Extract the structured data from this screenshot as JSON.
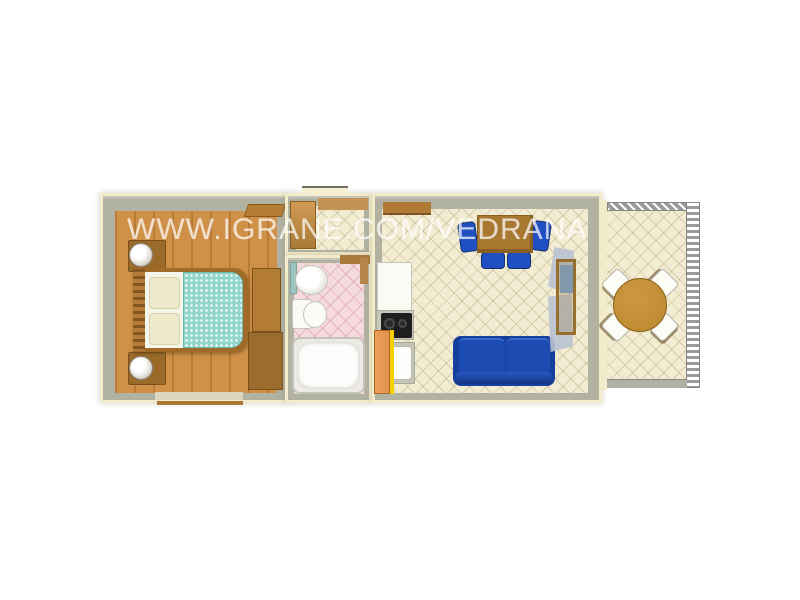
{
  "watermark": {
    "text": "WWW.IGRANE.COM/VEDRANA"
  },
  "palette": {
    "background": "#ffffff",
    "wall_outline": "#f3ecca",
    "wall_gray": "#b2b2a3",
    "wood_floor": "#cf9048",
    "tile_cream": "#f2ecd2",
    "tile_pink": "#f5dade",
    "bed_duvet": "#92d5cd",
    "bed_frame": "#a06a28",
    "pillow": "#efe9cb",
    "sofa_blue": "#1c4cb2",
    "chair_blue": "#1f4fc0",
    "table_brown": "#a87830",
    "terrace_table_brown": "#bb872f",
    "kitchen_door_orange": "#e2914c",
    "kitchen_door_yellow": "#f5d000",
    "cooktop_black": "#1e1e1e",
    "curtain_blue": "#b9c3d2",
    "railing_gray": "#9a9a9a",
    "shelf_teal": "#9cc4c0",
    "fixture_white": "#fbfbf6"
  },
  "plan": {
    "type": "apartment-floor-plan-3d-top-view",
    "rooms": [
      {
        "name": "bedroom",
        "floor": "wood",
        "furniture": [
          "double-bed",
          "nightstand-with-lamp-top",
          "nightstand-with-lamp-bottom",
          "wardrobe",
          "window-bottom-wall",
          "open-door"
        ]
      },
      {
        "name": "entrance-hall",
        "floor": "cream-tile",
        "furniture": [
          "entrance-door",
          "open-interior-door"
        ]
      },
      {
        "name": "bathroom",
        "floor": "pink-tile",
        "furniture": [
          "washbasin",
          "toilet",
          "bathtub",
          "shelf",
          "door-frame"
        ]
      },
      {
        "name": "living-room-kitchen",
        "floor": "cream-tile",
        "furniture": [
          "wall-shelf",
          "refrigerator",
          "cooktop-two-burners",
          "kitchen-sink",
          "open-door-orange",
          "dining-table",
          "dining-chair-left",
          "dining-chair-right",
          "dining-chair-bottom-1",
          "dining-chair-bottom-2",
          "sofa-blue",
          "terrace-window-with-curtains"
        ]
      },
      {
        "name": "terrace",
        "floor": "cream-tile",
        "furniture": [
          "round-table",
          "terrace-chair-nw",
          "terrace-chair-ne",
          "terrace-chair-sw",
          "terrace-chair-se",
          "railing-top",
          "railing-right",
          "railing-bottom"
        ]
      }
    ]
  }
}
